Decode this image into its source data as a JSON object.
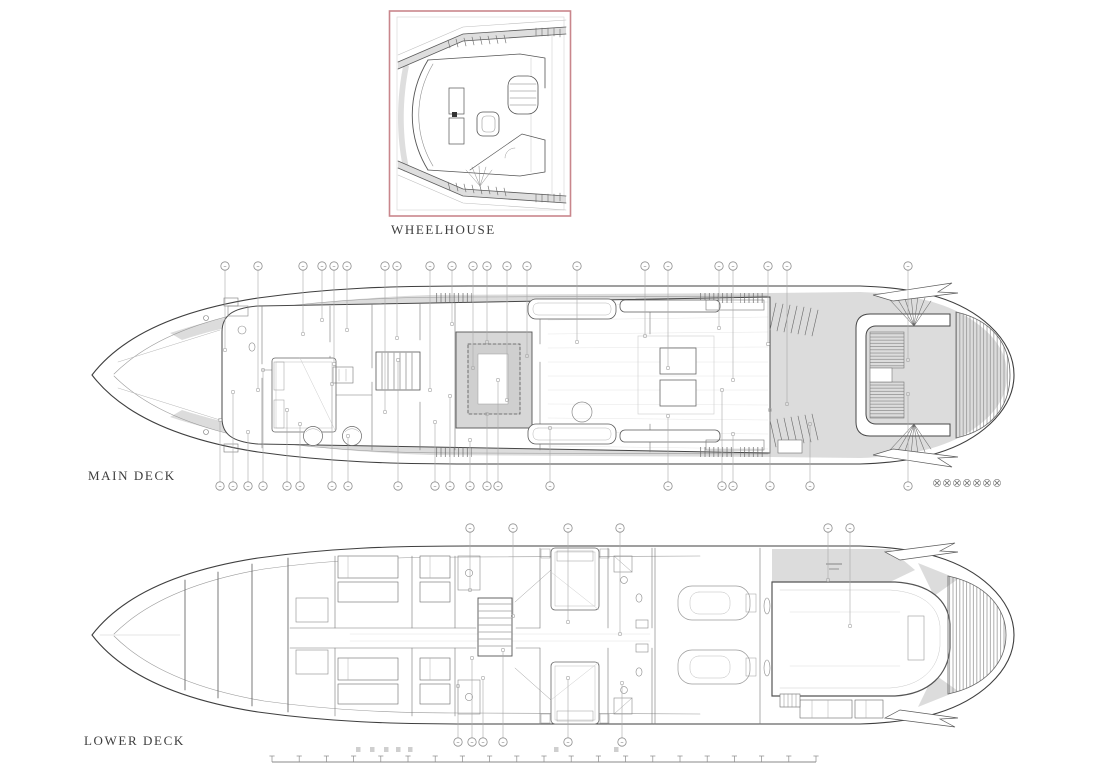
{
  "page": {
    "background": "#ffffff",
    "ink": "#3f3f3f",
    "line_light": "#8a8a8a",
    "shade_fill": "#dcdcdc",
    "accent_border": "#c9868c"
  },
  "labels": {
    "wheelhouse": "WHEELHOUSE",
    "main_deck": "MAIN DECK",
    "lower_deck": "LOWER DECK"
  },
  "figures": [
    {
      "id": "wheelhouse",
      "label": "WHEELHOUSE",
      "type": "deck-plan-detail"
    },
    {
      "id": "main-deck",
      "label": "MAIN DECK",
      "type": "deck-plan"
    },
    {
      "id": "lower-deck",
      "label": "LOWER DECK",
      "type": "deck-plan"
    }
  ],
  "callouts": {
    "style": {
      "radius": 4.2,
      "stroke": "#8f8f8f",
      "leader": "#a8a8a8",
      "note": "numbered reference bubbles, digits too small to read"
    },
    "groups": [
      {
        "id": "main-top",
        "y": 266,
        "dir": "down",
        "items": [
          {
            "x": 225,
            "len": 78
          },
          {
            "x": 258,
            "len": 118
          },
          {
            "x": 303,
            "len": 62
          },
          {
            "x": 322,
            "len": 48
          },
          {
            "x": 334,
            "len": 92
          },
          {
            "x": 347,
            "len": 58
          },
          {
            "x": 385,
            "len": 140
          },
          {
            "x": 397,
            "len": 66
          },
          {
            "x": 430,
            "len": 118
          },
          {
            "x": 452,
            "len": 52
          },
          {
            "x": 473,
            "len": 96
          },
          {
            "x": 487,
            "len": 70
          },
          {
            "x": 507,
            "len": 128
          },
          {
            "x": 527,
            "len": 84
          },
          {
            "x": 577,
            "len": 70
          },
          {
            "x": 645,
            "len": 64
          },
          {
            "x": 668,
            "len": 96
          },
          {
            "x": 719,
            "len": 56
          },
          {
            "x": 733,
            "len": 108
          },
          {
            "x": 768,
            "len": 72
          },
          {
            "x": 787,
            "len": 132
          },
          {
            "x": 908,
            "len": 88
          }
        ]
      },
      {
        "id": "main-bottom",
        "y": 486,
        "dir": "up",
        "items": [
          {
            "x": 220,
            "len": 60
          },
          {
            "x": 233,
            "len": 88
          },
          {
            "x": 248,
            "len": 48
          },
          {
            "x": 263,
            "len": 110
          },
          {
            "x": 287,
            "len": 70
          },
          {
            "x": 300,
            "len": 56
          },
          {
            "x": 332,
            "len": 96
          },
          {
            "x": 348,
            "len": 44
          },
          {
            "x": 398,
            "len": 120
          },
          {
            "x": 435,
            "len": 58
          },
          {
            "x": 450,
            "len": 84
          },
          {
            "x": 470,
            "len": 40
          },
          {
            "x": 487,
            "len": 66
          },
          {
            "x": 498,
            "len": 100
          },
          {
            "x": 550,
            "len": 52
          },
          {
            "x": 668,
            "len": 64
          },
          {
            "x": 722,
            "len": 90
          },
          {
            "x": 733,
            "len": 46
          },
          {
            "x": 770,
            "len": 70
          },
          {
            "x": 810,
            "len": 56
          },
          {
            "x": 908,
            "len": 86
          }
        ]
      },
      {
        "id": "lower-top",
        "y": 528,
        "dir": "down",
        "items": [
          {
            "x": 470,
            "len": 56
          },
          {
            "x": 513,
            "len": 82
          },
          {
            "x": 568,
            "len": 88
          },
          {
            "x": 620,
            "len": 100
          },
          {
            "x": 828,
            "len": 46
          },
          {
            "x": 850,
            "len": 92
          }
        ]
      },
      {
        "id": "lower-bottom",
        "y": 742,
        "dir": "up",
        "items": [
          {
            "x": 458,
            "len": 50
          },
          {
            "x": 472,
            "len": 78
          },
          {
            "x": 483,
            "len": 58
          },
          {
            "x": 503,
            "len": 86
          },
          {
            "x": 568,
            "len": 58
          },
          {
            "x": 622,
            "len": 53
          }
        ]
      }
    ],
    "x_markers": {
      "y": 483,
      "start_x": 937,
      "step": 10,
      "count": 7,
      "glyph": "circled-x"
    }
  },
  "scale_bar": {
    "x1": 272,
    "x2": 816,
    "y": 762,
    "ticks": 21,
    "faint_marks": [
      358,
      372,
      386,
      398,
      410,
      556,
      616
    ]
  }
}
